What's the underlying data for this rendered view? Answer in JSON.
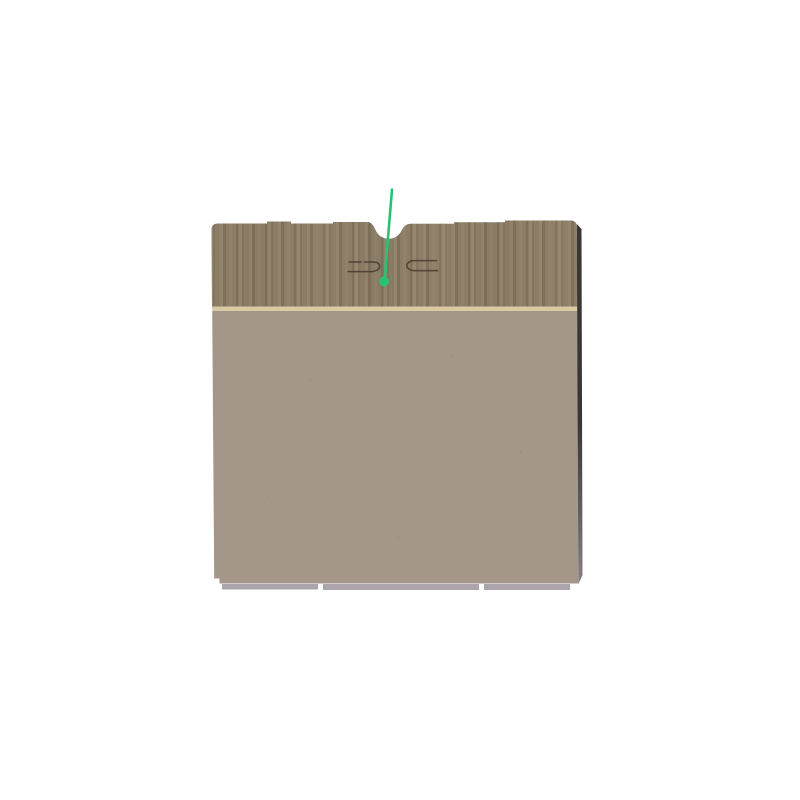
{
  "scene": {
    "subject": "cardboard-box-with-pointer-marker",
    "colors": {
      "background": "#ffffff",
      "flap_base": "#8c7e66",
      "flap_stripe_dark": "#6f6450",
      "flap_stripe_light": "#9e9077",
      "fold_edge": "#d9caa2",
      "panel": "#a49689",
      "panel_speckle": "#8f8276",
      "side_edge_dark": "#292523",
      "side_edge_light": "#7d747a",
      "bottom_edge_gray": "#a29aa2",
      "diecut_line": "#46392c",
      "pointer_green": "#2bc173"
    },
    "pointer": {
      "start": {
        "x": 392,
        "y": 189.5
      },
      "end": {
        "x": 384.8,
        "y": 276.5
      },
      "dot": {
        "x": 384.2,
        "y": 281.5,
        "r": 5
      },
      "line_width": 2.6
    }
  }
}
